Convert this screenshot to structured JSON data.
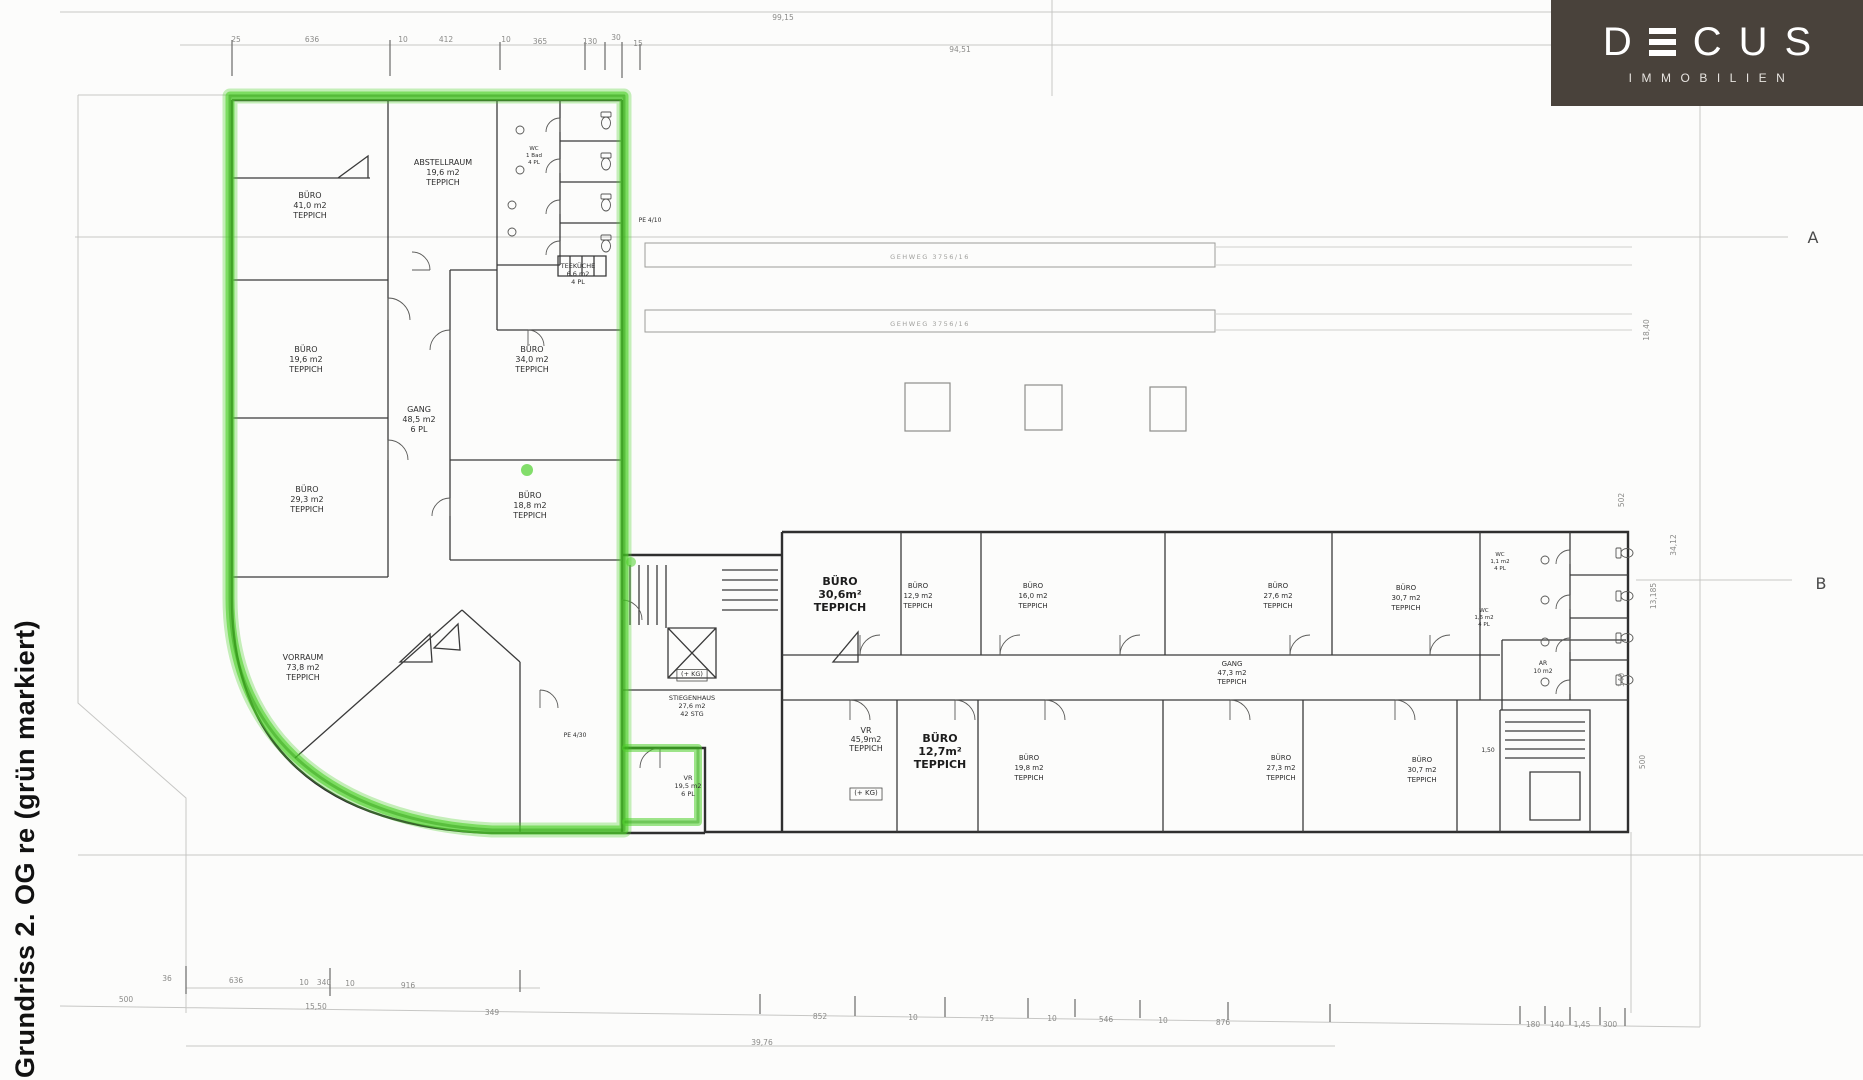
{
  "page": {
    "vertical_title": "Grundriss 2. OG re (grün markiert)",
    "background": "#fcfcfb"
  },
  "logo": {
    "bg_color": "#49423b",
    "text_color": "#ffffff",
    "letters": {
      "d": "D",
      "c": "C",
      "u": "U",
      "s": "S"
    },
    "subtitle": "IMMOBILIEN"
  },
  "plan": {
    "marker_color": "#4fd02c",
    "marker_core_color": "#2e9c12",
    "wall_color": "#2f2f2f",
    "faint_line_color": "#c7c7c5",
    "axis_labels": [
      {
        "t": "A",
        "x": 1813,
        "y": 243
      },
      {
        "t": "B",
        "x": 1821,
        "y": 589
      }
    ],
    "parcel_labels": [
      {
        "t": "GEHWEG 3756/16",
        "x": 930,
        "y": 259
      },
      {
        "t": "GEHWEG 3756/16",
        "x": 930,
        "y": 326
      }
    ],
    "room_labels": [
      {
        "x": 310,
        "y": 198,
        "lines": [
          "BÜRO",
          "41,0 m2",
          "TEPPICH"
        ]
      },
      {
        "x": 443,
        "y": 165,
        "lines": [
          "ABSTELLRAUM",
          "19,6 m2",
          "TEPPICH"
        ]
      },
      {
        "x": 306,
        "y": 352,
        "lines": [
          "BÜRO",
          "19,6 m2",
          "TEPPICH"
        ]
      },
      {
        "x": 419,
        "y": 412,
        "lines": [
          "GANG",
          "48,5 m2",
          "6 PL"
        ]
      },
      {
        "x": 532,
        "y": 352,
        "lines": [
          "BÜRO",
          "34,0 m2",
          "TEPPICH"
        ]
      },
      {
        "x": 307,
        "y": 492,
        "lines": [
          "BÜRO",
          "29,3 m2",
          "TEPPICH"
        ]
      },
      {
        "x": 530,
        "y": 498,
        "lines": [
          "BÜRO",
          "18,8 m2",
          "TEPPICH"
        ]
      },
      {
        "x": 303,
        "y": 660,
        "lines": [
          "VORRAUM",
          "73,8 m2",
          "TEPPICH"
        ]
      },
      {
        "x": 578,
        "y": 268,
        "lines": [
          "TEEKÜCHE",
          "6,6 m2",
          "4 PL"
        ],
        "s": 6.5,
        "lh": 8
      },
      {
        "x": 692,
        "y": 700,
        "lines": [
          "STIEGENHAUS",
          "27,6 m2",
          "42 STG"
        ],
        "s": 6.5,
        "lh": 8
      },
      {
        "x": 688,
        "y": 780,
        "lines": [
          "VR",
          "19,5 m2",
          "6 PL"
        ],
        "s": 6.5,
        "lh": 8
      },
      {
        "x": 840,
        "y": 585,
        "lines": [
          "BÜRO",
          "30,6m²",
          "TEPPICH"
        ],
        "s": 11,
        "lh": 13,
        "b": 1
      },
      {
        "x": 918,
        "y": 588,
        "lines": [
          "BÜRO",
          "12,9 m2",
          "TEPPICH"
        ],
        "s": 7
      },
      {
        "x": 1033,
        "y": 588,
        "lines": [
          "BÜRO",
          "16,0 m2",
          "TEPPICH"
        ],
        "s": 7
      },
      {
        "x": 1278,
        "y": 588,
        "lines": [
          "BÜRO",
          "27,6 m2",
          "TEPPICH"
        ],
        "s": 7
      },
      {
        "x": 1406,
        "y": 590,
        "lines": [
          "BÜRO",
          "30,7 m2",
          "TEPPICH"
        ],
        "s": 7
      },
      {
        "x": 1232,
        "y": 666,
        "lines": [
          "GANG",
          "47,3 m2",
          "TEPPICH"
        ],
        "s": 7,
        "lh": 9
      },
      {
        "x": 866,
        "y": 733,
        "lines": [
          "VR",
          "45,9m2",
          "TEPPICH"
        ],
        "s": 8,
        "lh": 9
      },
      {
        "x": 940,
        "y": 742,
        "lines": [
          "BÜRO",
          "12,7m²",
          "TEPPICH"
        ],
        "s": 11,
        "lh": 13,
        "b": 1
      },
      {
        "x": 1029,
        "y": 760,
        "lines": [
          "BÜRO",
          "19,8 m2",
          "TEPPICH"
        ],
        "s": 7
      },
      {
        "x": 1281,
        "y": 760,
        "lines": [
          "BÜRO",
          "27,3 m2",
          "TEPPICH"
        ],
        "s": 7
      },
      {
        "x": 1422,
        "y": 762,
        "lines": [
          "BÜRO",
          "30,7 m2",
          "TEPPICH"
        ],
        "s": 7
      },
      {
        "x": 1543,
        "y": 665,
        "lines": [
          "AR",
          "10 m2"
        ],
        "s": 6,
        "lh": 8
      }
    ],
    "small_labels": [
      {
        "x": 534,
        "y": 150,
        "lines": [
          "WC",
          "1 Bad",
          "4 PL"
        ],
        "s": 5.5,
        "lh": 7
      },
      {
        "x": 1500,
        "y": 556,
        "lines": [
          "WC",
          "1,1 m2",
          "4 PL"
        ],
        "s": 5.5,
        "lh": 7
      },
      {
        "x": 1484,
        "y": 612,
        "lines": [
          "WC",
          "1,6 m2",
          "4 PL"
        ],
        "s": 5.5,
        "lh": 7
      },
      {
        "x": 650,
        "y": 222,
        "lines": [
          "PE 4/10"
        ],
        "s": 6
      },
      {
        "x": 575,
        "y": 737,
        "lines": [
          "PE 4/30"
        ],
        "s": 6
      },
      {
        "x": 692,
        "y": 676,
        "lines": [
          "(+ KG)"
        ],
        "s": 6.5,
        "box": 1
      },
      {
        "x": 866,
        "y": 795,
        "lines": [
          "(+ KG)"
        ],
        "s": 7,
        "box": 1
      },
      {
        "x": 1488,
        "y": 752,
        "lines": [
          "1,50"
        ],
        "s": 6
      }
    ],
    "dim_labels": [
      {
        "t": "99,15",
        "x": 783,
        "y": 20
      },
      {
        "t": "94,51",
        "x": 960,
        "y": 52
      },
      {
        "t": "25",
        "x": 236,
        "y": 42
      },
      {
        "t": "636",
        "x": 312,
        "y": 42
      },
      {
        "t": "10",
        "x": 403,
        "y": 42
      },
      {
        "t": "412",
        "x": 446,
        "y": 42
      },
      {
        "t": "10",
        "x": 506,
        "y": 42
      },
      {
        "t": "365",
        "x": 540,
        "y": 44
      },
      {
        "t": "130",
        "x": 590,
        "y": 44
      },
      {
        "t": "30",
        "x": 616,
        "y": 40
      },
      {
        "t": "15",
        "x": 638,
        "y": 46
      },
      {
        "t": "36",
        "x": 167,
        "y": 981
      },
      {
        "t": "636",
        "x": 236,
        "y": 983
      },
      {
        "t": "10",
        "x": 304,
        "y": 985
      },
      {
        "t": "340",
        "x": 324,
        "y": 985
      },
      {
        "t": "10",
        "x": 350,
        "y": 986
      },
      {
        "t": "916",
        "x": 408,
        "y": 988
      },
      {
        "t": "500",
        "x": 126,
        "y": 1002
      },
      {
        "t": "15,50",
        "x": 316,
        "y": 1009
      },
      {
        "t": "349",
        "x": 492,
        "y": 1015
      },
      {
        "t": "852",
        "x": 820,
        "y": 1019
      },
      {
        "t": "10",
        "x": 913,
        "y": 1020
      },
      {
        "t": "715",
        "x": 987,
        "y": 1021
      },
      {
        "t": "10",
        "x": 1052,
        "y": 1021
      },
      {
        "t": "546",
        "x": 1106,
        "y": 1022
      },
      {
        "t": "10",
        "x": 1163,
        "y": 1023
      },
      {
        "t": "876",
        "x": 1223,
        "y": 1025
      },
      {
        "t": "180",
        "x": 1533,
        "y": 1027
      },
      {
        "t": "140",
        "x": 1557,
        "y": 1027
      },
      {
        "t": "1,45",
        "x": 1582,
        "y": 1027
      },
      {
        "t": "300",
        "x": 1610,
        "y": 1027
      },
      {
        "t": "39,76",
        "x": 762,
        "y": 1045
      },
      {
        "t": "18,40",
        "x": 1649,
        "y": 330,
        "r": -90
      },
      {
        "t": "502",
        "x": 1624,
        "y": 500,
        "r": -90
      },
      {
        "t": "34,12",
        "x": 1676,
        "y": 545,
        "r": -90
      },
      {
        "t": "13,185",
        "x": 1656,
        "y": 596,
        "r": -90
      },
      {
        "t": "140",
        "x": 1624,
        "y": 680,
        "r": -90
      },
      {
        "t": "500",
        "x": 1645,
        "y": 762,
        "r": -90
      }
    ]
  }
}
